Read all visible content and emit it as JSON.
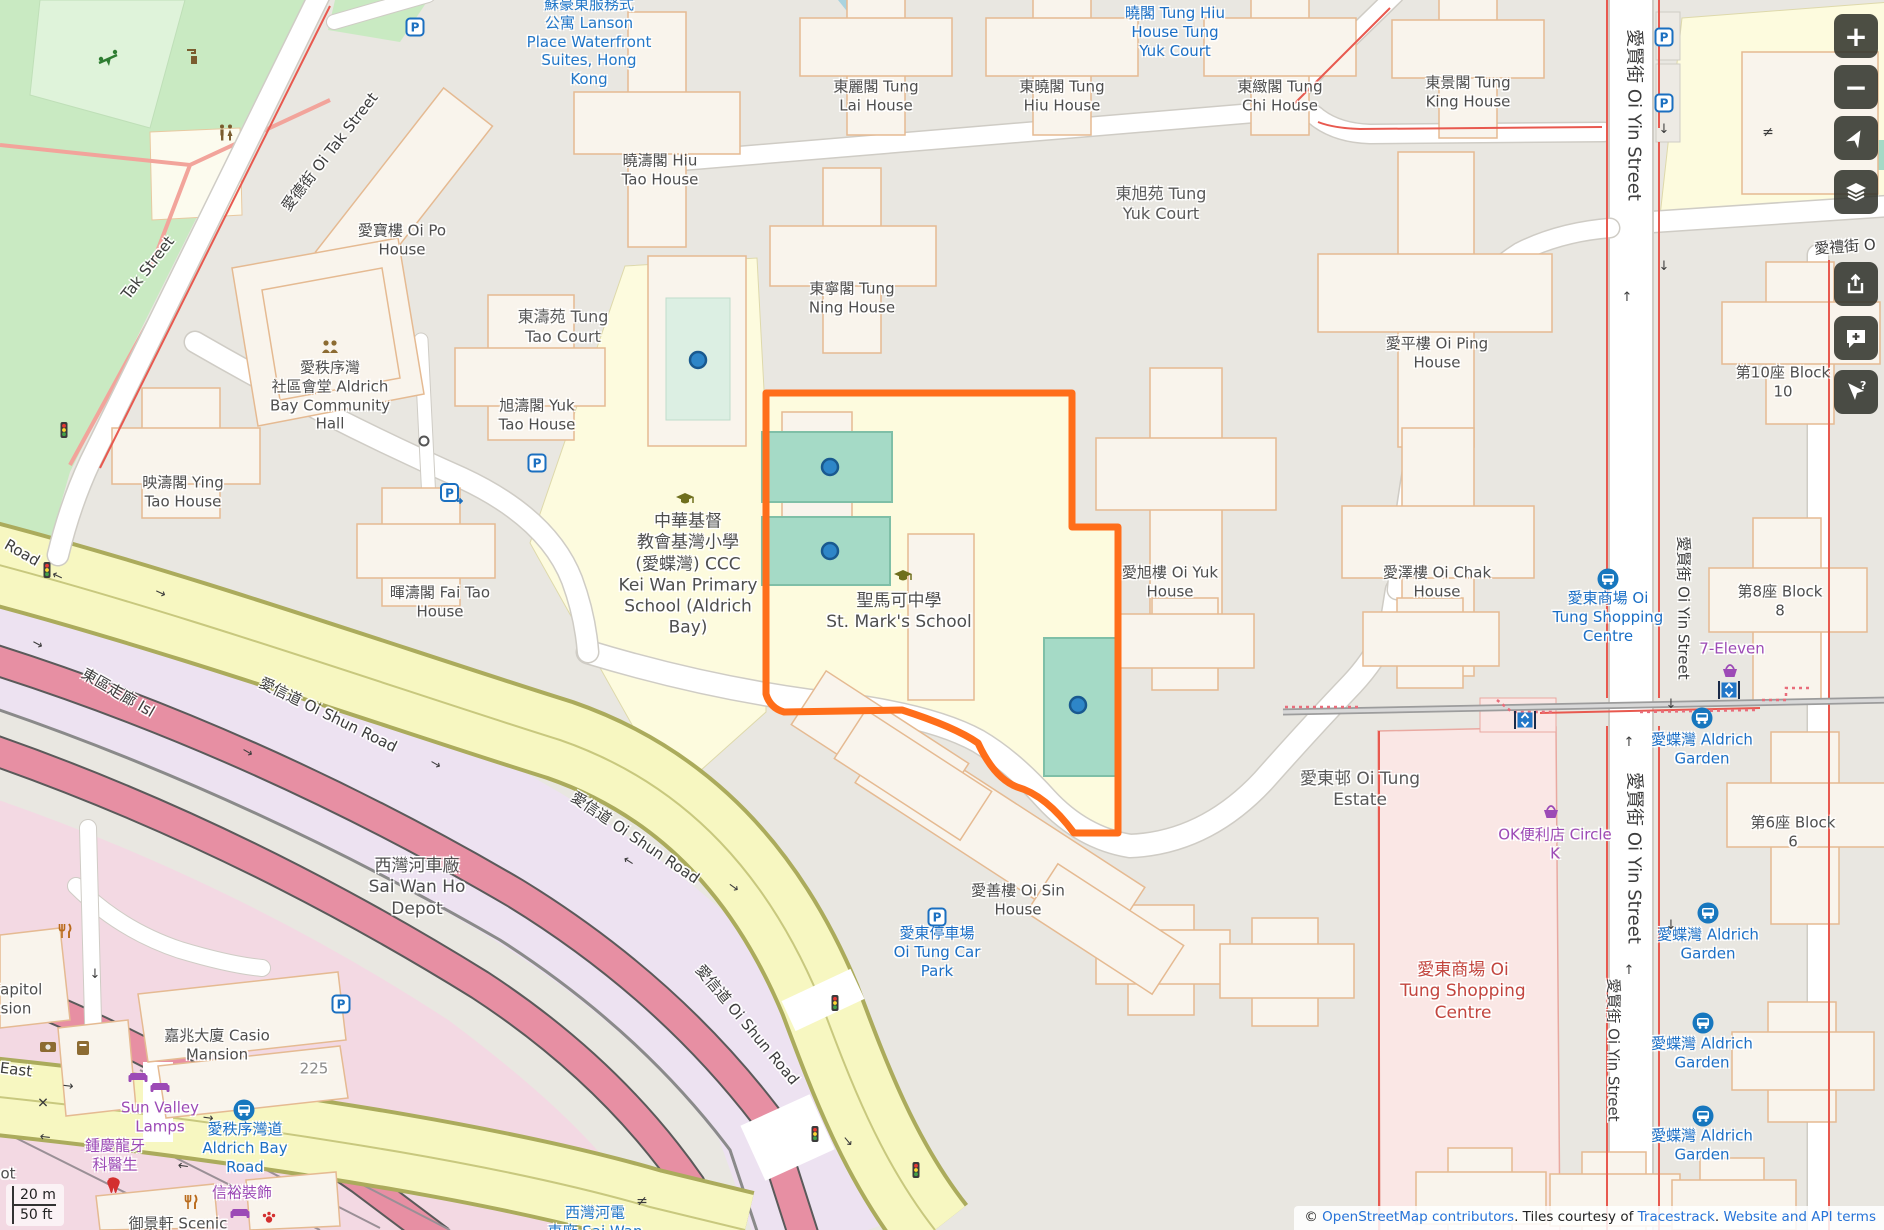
{
  "colors": {
    "boundary_orange": "#FF6E1A",
    "court_teal": "#A5DAC6",
    "road_yellow": "#F7F7C1",
    "corridor_pink": "#E78FA3",
    "park_green": "#C9EAC2",
    "bus_blue": "#1B6FC6",
    "poi_purple": "#9C4AB6",
    "mall_red": "#C2453E",
    "link_blue": "#2673D8",
    "water_blue": "#A9D3DF"
  },
  "controls": {
    "zoom_in": "+",
    "zoom_out": "−"
  },
  "scalebar": {
    "metric": "20 m",
    "imperial": "50 ft"
  },
  "attribution": {
    "prefix": "© ",
    "osm_link": "OpenStreetMap contributors",
    "mid": ". Tiles courtesy of ",
    "tiles_link": "Tracestrack",
    "sep": ". ",
    "terms_link": "Website and API terms"
  },
  "map": {
    "labels": [
      {
        "n": "lanson-place",
        "c": "blue",
        "x": 589,
        "y": 42,
        "l": [
          "蘇豪東服務式",
          "公寓 Lanson",
          "Place Waterfront",
          "Suites, Hong",
          "Kong"
        ]
      },
      {
        "n": "bus-stop-tung-hiu-yuk",
        "c": "bus",
        "x": 1175,
        "y": 32,
        "l": [
          "曉閣 Tung Hiu",
          "House Tung",
          "Yuk Court"
        ]
      },
      {
        "n": "tung-lai-house",
        "x": 876,
        "y": 96,
        "l": [
          "東麗閣 Tung",
          "Lai House"
        ]
      },
      {
        "n": "tung-hiu-house",
        "x": 1062,
        "y": 96,
        "l": [
          "東曉閣 Tung",
          "Hiu House"
        ]
      },
      {
        "n": "tung-chi-house",
        "x": 1280,
        "y": 96,
        "l": [
          "東緻閣 Tung",
          "Chi House"
        ]
      },
      {
        "n": "tung-king-house",
        "x": 1468,
        "y": 92,
        "l": [
          "東景閣 Tung",
          "King House"
        ]
      },
      {
        "n": "hiu-tao-house",
        "x": 660,
        "y": 170,
        "l": [
          "曉濤閣 Hiu",
          "Tao House"
        ]
      },
      {
        "n": "tung-yuk-court",
        "c": "place",
        "x": 1161,
        "y": 204,
        "l": [
          "東旭苑 Tung",
          "Yuk Court"
        ]
      },
      {
        "n": "oi-po-house",
        "x": 402,
        "y": 240,
        "l": [
          "愛寶樓 Oi Po",
          "House"
        ]
      },
      {
        "n": "oi-tak-street",
        "c": "street",
        "r": -52,
        "x": 330,
        "y": 152,
        "l": [
          "愛德街 Oi Tak Street"
        ]
      },
      {
        "n": "tak-street",
        "c": "street",
        "r": -52,
        "x": 148,
        "y": 268,
        "l": [
          "Tak Street"
        ]
      },
      {
        "n": "tung-ning-house",
        "x": 852,
        "y": 298,
        "l": [
          "東寧閣 Tung",
          "Ning House"
        ]
      },
      {
        "n": "tung-tao-court",
        "c": "place",
        "x": 563,
        "y": 327,
        "l": [
          "東濤苑 Tung",
          "Tao Court"
        ]
      },
      {
        "n": "yuk-tao-house",
        "x": 537,
        "y": 415,
        "l": [
          "旭濤閣 Yuk",
          "Tao House"
        ]
      },
      {
        "n": "aldrich-bay-community-hall",
        "x": 330,
        "y": 396,
        "l": [
          "愛秩序灣",
          "社區會堂 Aldrich",
          "Bay Community",
          "Hall"
        ]
      },
      {
        "n": "ying-tao-house",
        "x": 183,
        "y": 492,
        "l": [
          "映濤閣 Ying",
          "Tao House"
        ]
      },
      {
        "n": "fai-tao-house",
        "x": 440,
        "y": 602,
        "l": [
          "暉濤閣 Fai Tao",
          "House"
        ]
      },
      {
        "n": "oi-ping-house",
        "x": 1437,
        "y": 353,
        "l": [
          "愛平樓 Oi Ping",
          "House"
        ]
      },
      {
        "n": "block-10",
        "x": 1783,
        "y": 382,
        "l": [
          "第10座 Block",
          "10"
        ]
      },
      {
        "n": "kei-wan-primary-school",
        "s": 17,
        "x": 688,
        "y": 575,
        "l": [
          "中華基督",
          "教會基灣小學",
          "(愛蝶灣) CCC",
          "Kei Wan Primary",
          "School (Aldrich",
          "Bay)"
        ]
      },
      {
        "n": "st-marks-school",
        "s": 17,
        "x": 899,
        "y": 612,
        "l": [
          "聖馬可中學",
          "St. Mark's School"
        ]
      },
      {
        "n": "oi-yuk-house",
        "x": 1170,
        "y": 582,
        "l": [
          "愛旭樓 Oi Yuk",
          "House"
        ]
      },
      {
        "n": "oi-chak-house",
        "x": 1437,
        "y": 582,
        "l": [
          "愛澤樓 Oi Chak",
          "House"
        ]
      },
      {
        "n": "block-8",
        "x": 1780,
        "y": 601,
        "l": [
          "第8座 Block",
          "8"
        ]
      },
      {
        "n": "oi-yin-street-1",
        "c": "street",
        "r": 90,
        "s": 18,
        "x": 1633,
        "y": 115,
        "l": [
          "愛賢街 Oi Yin Street"
        ]
      },
      {
        "n": "oi-yin-street-2",
        "c": "street",
        "r": 90,
        "s": 15,
        "x": 1683,
        "y": 608,
        "l": [
          "愛賢街 Oi Yin Street"
        ]
      },
      {
        "n": "oi-yin-street-3",
        "c": "street",
        "r": 90,
        "s": 18,
        "x": 1633,
        "y": 858,
        "l": [
          "愛賢街 Oi Yin Street"
        ]
      },
      {
        "n": "oi-yin-street-4",
        "c": "street",
        "r": 90,
        "s": 15,
        "x": 1613,
        "y": 1050,
        "l": [
          "愛賢街 Oi Yin Street"
        ]
      },
      {
        "n": "oi-lai-street",
        "c": "street",
        "r": -4,
        "x": 1845,
        "y": 247,
        "l": [
          "愛禮街 O"
        ]
      },
      {
        "n": "bus-stop-oi-tung-shopping-centre",
        "c": "bus",
        "x": 1608,
        "y": 617,
        "l": [
          "愛東商場 Oi",
          "Tung Shopping",
          "Centre"
        ]
      },
      {
        "n": "seven-eleven",
        "c": "purple",
        "x": 1732,
        "y": 649,
        "l": [
          "7-Eleven"
        ]
      },
      {
        "n": "circle-k",
        "c": "purple",
        "x": 1555,
        "y": 844,
        "l": [
          "OK便利店 Circle",
          "K"
        ]
      },
      {
        "n": "bus-stop-aldrich-garden-1",
        "c": "bus",
        "x": 1702,
        "y": 749,
        "l": [
          "愛蝶灣 Aldrich",
          "Garden"
        ]
      },
      {
        "n": "bus-stop-aldrich-garden-2",
        "c": "bus",
        "x": 1708,
        "y": 944,
        "l": [
          "愛蝶灣 Aldrich",
          "Garden"
        ]
      },
      {
        "n": "bus-stop-aldrich-garden-3",
        "c": "bus",
        "x": 1702,
        "y": 1053,
        "l": [
          "愛蝶灣 Aldrich",
          "Garden"
        ]
      },
      {
        "n": "bus-stop-aldrich-garden-4",
        "c": "bus",
        "x": 1702,
        "y": 1145,
        "l": [
          "愛蝶灣 Aldrich",
          "Garden"
        ]
      },
      {
        "n": "oi-tung-estate",
        "c": "place",
        "s": 17,
        "x": 1360,
        "y": 790,
        "l": [
          "愛東邨 Oi Tung",
          "Estate"
        ]
      },
      {
        "n": "block-6",
        "x": 1793,
        "y": 832,
        "l": [
          "第6座 Block",
          "6"
        ]
      },
      {
        "n": "oi-sin-house",
        "x": 1018,
        "y": 900,
        "l": [
          "愛善樓 Oi Sin",
          "House"
        ]
      },
      {
        "n": "bus-stop-oi-tung-car-park",
        "c": "bus",
        "x": 937,
        "y": 952,
        "l": [
          "愛東停車場",
          "Oi Tung Car",
          "Park"
        ]
      },
      {
        "n": "oi-tung-shopping-centre",
        "c": "red",
        "s": 17,
        "x": 1463,
        "y": 992,
        "l": [
          "愛東商場 Oi",
          "Tung Shopping",
          "Centre"
        ]
      },
      {
        "n": "road-partial",
        "c": "street",
        "r": 30,
        "x": 22,
        "y": 553,
        "l": [
          "Road"
        ]
      },
      {
        "n": "oi-shun-road-1",
        "c": "street",
        "r": 26,
        "x": 328,
        "y": 715,
        "l": [
          "愛信道 Oi Shun Road"
        ]
      },
      {
        "n": "oi-shun-road-2",
        "c": "street",
        "r": 34,
        "x": 635,
        "y": 838,
        "l": [
          "愛信道 Oi Shun Road"
        ]
      },
      {
        "n": "oi-shun-road-3",
        "c": "street",
        "r": 50,
        "x": 747,
        "y": 1025,
        "l": [
          "愛信道 Oi Shun Road"
        ]
      },
      {
        "n": "island-eastern-corridor",
        "c": "street",
        "r": 30,
        "x": 118,
        "y": 693,
        "l": [
          "東區走廊 Isl"
        ]
      },
      {
        "n": "sai-wan-ho-depot",
        "s": 17,
        "x": 417,
        "y": 888,
        "l": [
          "西灣河車廠",
          "Sai Wan Ho",
          "Depot"
        ]
      },
      {
        "n": "capitol-mansion",
        "x": 16,
        "y": 999,
        "l": [
          "Capitol",
          "sion"
        ]
      },
      {
        "n": "casio-mansion",
        "x": 217,
        "y": 1045,
        "l": [
          "嘉兆大廈 Casio",
          "Mansion"
        ]
      },
      {
        "n": "address-225",
        "c": "addr",
        "x": 314,
        "y": 1069,
        "l": [
          "225"
        ]
      },
      {
        "n": "east-label",
        "c": "street",
        "r": 7,
        "x": 16,
        "y": 1070,
        "l": [
          "East"
        ]
      },
      {
        "n": "sun-valley-lamps",
        "c": "purple",
        "x": 160,
        "y": 1117,
        "l": [
          "Sun Valley",
          "Lamps"
        ]
      },
      {
        "n": "bus-stop-aldrich-bay-road",
        "c": "bus",
        "x": 245,
        "y": 1148,
        "l": [
          "愛秩序灣道",
          "Aldrich Bay",
          "Road"
        ]
      },
      {
        "n": "dentist-chung",
        "c": "purple",
        "x": 115,
        "y": 1155,
        "l": [
          "鍾慶龍牙",
          "科醫生"
        ]
      },
      {
        "n": "shun-yu-decoration",
        "c": "purple",
        "x": 242,
        "y": 1193,
        "l": [
          "信裕裝飾"
        ]
      },
      {
        "n": "scenic-court",
        "x": 178,
        "y": 1224,
        "l": [
          "御景軒 Scenic"
        ]
      },
      {
        "n": "sai-wan-ho-tram-depot",
        "c": "blue",
        "x": 595,
        "y": 1222,
        "l": [
          "西灣河電",
          "車廠 Sai Wan"
        ]
      },
      {
        "n": "ot-partial",
        "x": 8,
        "y": 1174,
        "l": [
          "ot"
        ]
      },
      {
        "n": "oneway-arrow",
        "c": "arrow",
        "x": 1664,
        "y": 267,
        "l": [
          "↓"
        ]
      },
      {
        "n": "oneway-arrow",
        "c": "arrow",
        "x": 1627,
        "y": 298,
        "l": [
          "↑"
        ]
      },
      {
        "n": "oneway-arrow",
        "c": "arrow",
        "x": 1671,
        "y": 705,
        "l": [
          "↓"
        ]
      },
      {
        "n": "oneway-arrow",
        "c": "arrow",
        "x": 1629,
        "y": 743,
        "l": [
          "↑"
        ]
      },
      {
        "n": "oneway-arrow",
        "c": "arrow",
        "x": 1671,
        "y": 926,
        "l": [
          "↓"
        ]
      },
      {
        "n": "oneway-arrow",
        "c": "arrow",
        "x": 1629,
        "y": 971,
        "l": [
          "↑"
        ]
      },
      {
        "n": "oneway-arrow",
        "c": "arrow",
        "x": 1664,
        "y": 130,
        "l": [
          "↓"
        ]
      },
      {
        "n": "oneway-arrow",
        "c": "arrow",
        "r": 25,
        "x": 160,
        "y": 594,
        "l": [
          "→"
        ]
      },
      {
        "n": "oneway-arrow",
        "c": "arrow",
        "r": 25,
        "x": 57,
        "y": 577,
        "l": [
          "←"
        ]
      },
      {
        "n": "oneway-arrow",
        "c": "arrow",
        "r": 30,
        "x": 435,
        "y": 765,
        "l": [
          "→"
        ]
      },
      {
        "n": "oneway-arrow",
        "c": "arrow",
        "r": 33,
        "x": 628,
        "y": 862,
        "l": [
          "←"
        ]
      },
      {
        "n": "oneway-arrow",
        "c": "arrow",
        "r": 35,
        "x": 733,
        "y": 888,
        "l": [
          "→"
        ]
      },
      {
        "n": "oneway-arrow",
        "c": "arrow",
        "r": 28,
        "x": 37,
        "y": 645,
        "l": [
          "→"
        ]
      },
      {
        "n": "oneway-arrow",
        "c": "arrow",
        "r": 30,
        "x": 247,
        "y": 753,
        "l": [
          "→"
        ]
      },
      {
        "n": "oneway-arrow",
        "c": "arrow",
        "r": 7,
        "x": 68,
        "y": 1087,
        "l": [
          "→"
        ]
      },
      {
        "n": "oneway-arrow",
        "c": "arrow",
        "r": 7,
        "x": 45,
        "y": 1138,
        "l": [
          "←"
        ]
      },
      {
        "n": "oneway-arrow",
        "c": "arrow",
        "r": 8,
        "x": 208,
        "y": 1119,
        "l": [
          "→"
        ]
      },
      {
        "n": "oneway-arrow",
        "c": "arrow",
        "r": 8,
        "x": 183,
        "y": 1167,
        "l": [
          "←"
        ]
      },
      {
        "n": "oneway-arrow",
        "c": "arrow",
        "x": 95,
        "y": 975,
        "l": [
          "↓"
        ]
      },
      {
        "n": "oneway-arrow",
        "c": "arrow",
        "r": 50,
        "x": 847,
        "y": 1142,
        "l": [
          "→"
        ]
      },
      {
        "n": "level-crossing-mark",
        "c": "sym",
        "x": 43,
        "y": 1104,
        "l": [
          "✕"
        ]
      },
      {
        "n": "gate-mark",
        "c": "sym",
        "x": 1768,
        "y": 133,
        "l": [
          "≠"
        ]
      },
      {
        "n": "gate-mark",
        "c": "sym",
        "x": 642,
        "y": 1202,
        "l": [
          "≠"
        ]
      }
    ],
    "icons": [
      {
        "t": "parking",
        "n": "parking-icon",
        "x": 415,
        "y": 27
      },
      {
        "t": "parking",
        "n": "parking-icon",
        "x": 1664,
        "y": 37
      },
      {
        "t": "parking",
        "n": "parking-icon",
        "x": 1664,
        "y": 103
      },
      {
        "t": "parking",
        "n": "parking-icon",
        "x": 537,
        "y": 463
      },
      {
        "t": "parking",
        "n": "parking-icon",
        "x": 937,
        "y": 917
      },
      {
        "t": "parking",
        "n": "parking-icon",
        "x": 341,
        "y": 1004
      },
      {
        "t": "parkarrow",
        "n": "parking-entrance-icon",
        "x": 451,
        "y": 493
      },
      {
        "t": "bus",
        "n": "bus-stop-icon",
        "x": 244,
        "y": 1110
      },
      {
        "t": "bus",
        "n": "bus-stop-icon",
        "x": 1608,
        "y": 579
      },
      {
        "t": "bus",
        "n": "bus-stop-icon",
        "x": 1702,
        "y": 718
      },
      {
        "t": "bus",
        "n": "bus-stop-icon",
        "x": 1708,
        "y": 913
      },
      {
        "t": "bus",
        "n": "bus-stop-icon",
        "x": 1703,
        "y": 1023
      },
      {
        "t": "bus",
        "n": "bus-stop-icon",
        "x": 1703,
        "y": 1116
      },
      {
        "t": "elevator",
        "n": "elevator-icon",
        "x": 1525,
        "y": 720
      },
      {
        "t": "elevator",
        "n": "elevator-icon",
        "x": 1729,
        "y": 690
      },
      {
        "t": "light",
        "n": "traffic-signal-icon",
        "x": 64,
        "y": 430
      },
      {
        "t": "light",
        "n": "traffic-signal-icon",
        "x": 47,
        "y": 570
      },
      {
        "t": "light",
        "n": "traffic-signal-icon",
        "x": 835,
        "y": 1003
      },
      {
        "t": "light",
        "n": "traffic-signal-icon",
        "x": 815,
        "y": 1134
      },
      {
        "t": "light",
        "n": "traffic-signal-icon",
        "x": 916,
        "y": 1170
      },
      {
        "t": "school",
        "n": "school-icon",
        "x": 685,
        "y": 498
      },
      {
        "t": "school",
        "n": "school-icon",
        "x": 903,
        "y": 575
      },
      {
        "t": "community",
        "n": "community-centre-icon",
        "x": 330,
        "y": 347
      },
      {
        "t": "play",
        "n": "playground-icon",
        "x": 108,
        "y": 60
      },
      {
        "t": "water",
        "n": "drinking-water-icon",
        "x": 193,
        "y": 57
      },
      {
        "t": "wc",
        "n": "toilets-icon",
        "x": 226,
        "y": 133
      },
      {
        "t": "rest",
        "n": "restaurant-icon",
        "x": 65,
        "y": 932
      },
      {
        "t": "rest",
        "n": "restaurant-icon",
        "x": 191,
        "y": 1203
      },
      {
        "t": "bank",
        "n": "bank-icon",
        "x": 48,
        "y": 1047
      },
      {
        "t": "post",
        "n": "post-box-icon",
        "x": 83,
        "y": 1048
      },
      {
        "t": "sofa",
        "n": "furniture-shop-icon",
        "x": 138,
        "y": 1077
      },
      {
        "t": "sofa",
        "n": "furniture-shop-icon",
        "x": 160,
        "y": 1087
      },
      {
        "t": "sofa",
        "n": "furniture-shop-icon",
        "x": 240,
        "y": 1213
      },
      {
        "t": "bask",
        "n": "convenience-store-icon",
        "x": 1730,
        "y": 670
      },
      {
        "t": "bask",
        "n": "convenience-store-icon",
        "x": 1551,
        "y": 811
      },
      {
        "t": "tooth",
        "n": "dentist-icon",
        "x": 113,
        "y": 1185
      },
      {
        "t": "paw",
        "n": "pet-shop-icon",
        "x": 269,
        "y": 1218
      },
      {
        "t": "dot",
        "n": "pitch-marker",
        "x": 698,
        "y": 360
      },
      {
        "t": "dot",
        "n": "pitch-marker",
        "x": 830,
        "y": 467
      },
      {
        "t": "dot",
        "n": "pitch-marker",
        "x": 830,
        "y": 551
      },
      {
        "t": "dot",
        "n": "pitch-marker",
        "x": 1078,
        "y": 705
      },
      {
        "t": "rnd",
        "n": "mini-roundabout-icon",
        "x": 424,
        "y": 441
      }
    ]
  }
}
